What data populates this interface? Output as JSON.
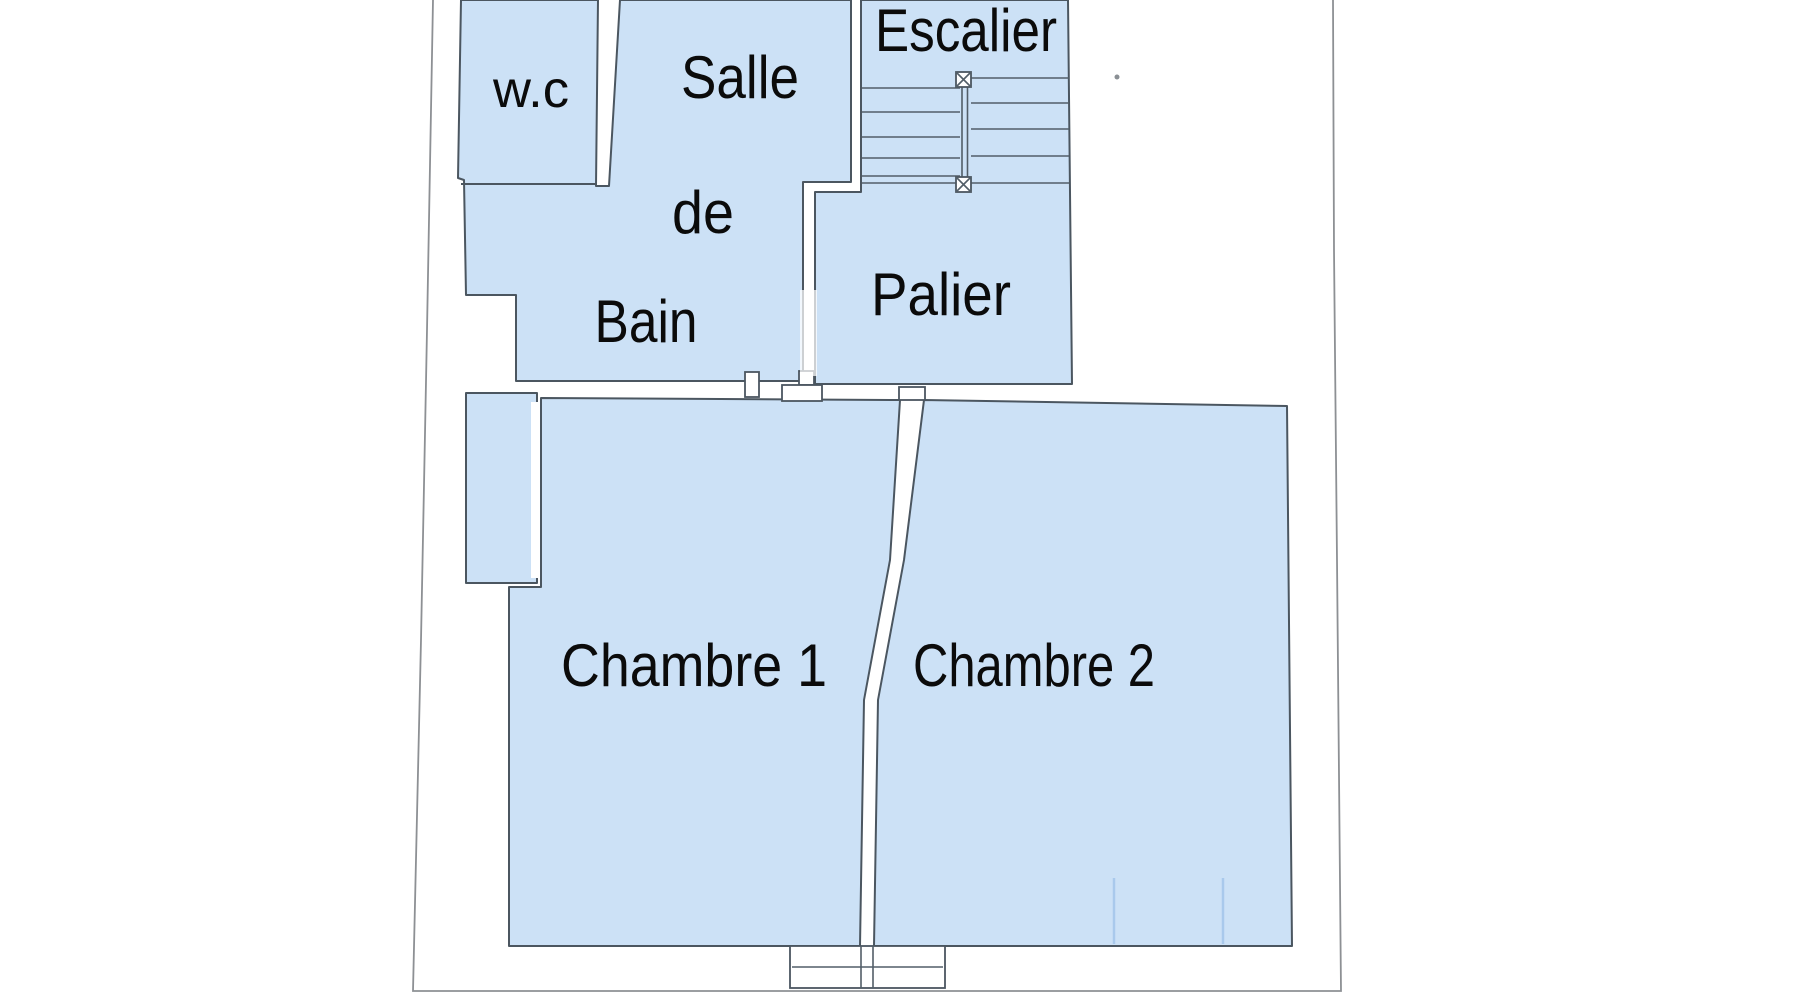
{
  "plan": {
    "type": "floor-plan",
    "language": "fr",
    "rooms": [
      {
        "id": "wc",
        "label": "w.c"
      },
      {
        "id": "salle-de-bain",
        "label": "Salle de Bain",
        "label_lines": [
          "Salle",
          "de",
          "Bain"
        ]
      },
      {
        "id": "escalier",
        "label": "Escalier"
      },
      {
        "id": "palier",
        "label": "Palier"
      },
      {
        "id": "chambre-1",
        "label": "Chambre 1"
      },
      {
        "id": "chambre-2",
        "label": "Chambre 2"
      }
    ],
    "features": [
      "stairs-with-central-handrail-and-newel-posts",
      "bay-window-left-of-chambre-1",
      "window-below-chambre-1-and-chambre-2",
      "door-opening-between-palier-and-salle-de-bain"
    ],
    "colors": {
      "background": "#ffffff",
      "room_fill": "#cce1f6",
      "wall_line": "#4b5660",
      "stair_line": "#525e68",
      "page_border": "#8d9094",
      "glazing_line": "#a9c9ec",
      "text": "#0b0b0b"
    }
  }
}
